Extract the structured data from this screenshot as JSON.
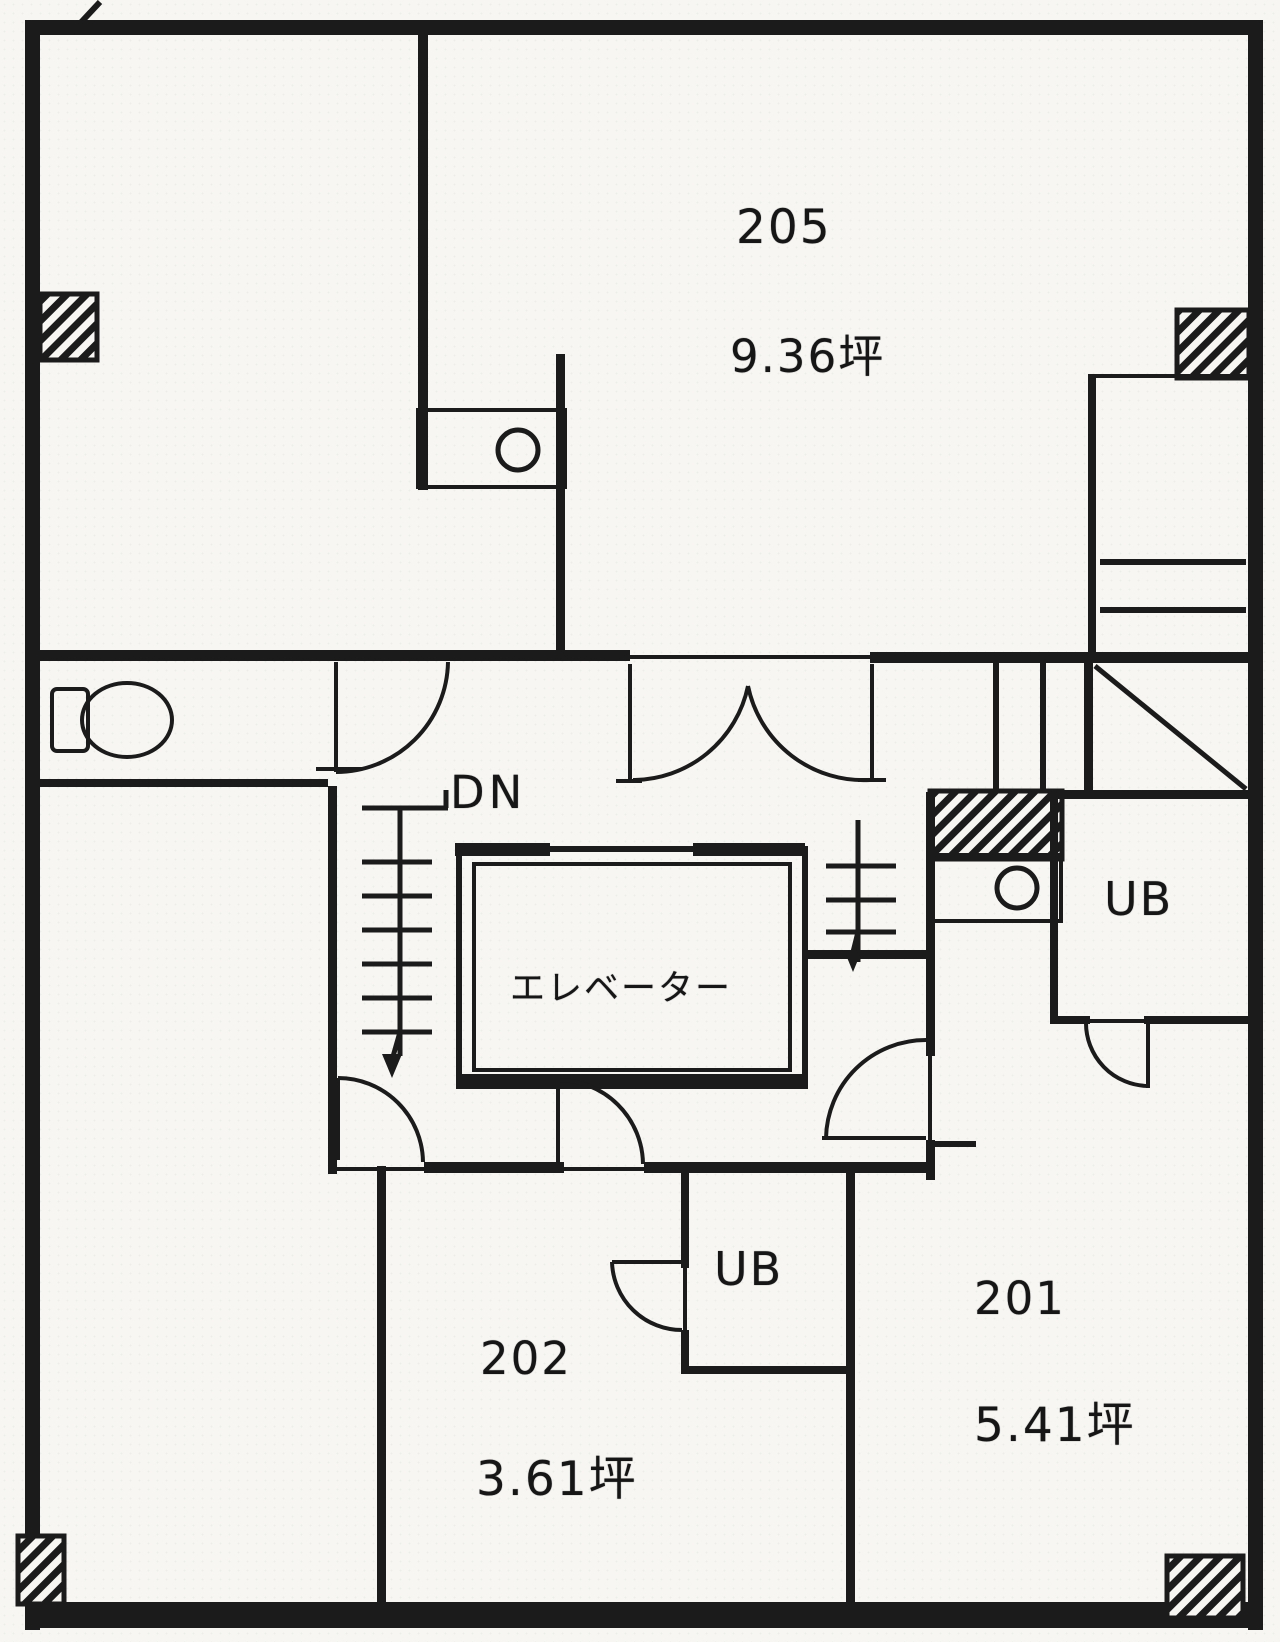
{
  "document": {
    "kind": "scanned architectural floor plan",
    "language": "Japanese"
  },
  "colors": {
    "ink": "#1b1b1b",
    "paper": "#f7f6f3"
  },
  "rooms": [
    {
      "number": "205",
      "area_label": "9.36坪",
      "area_tsubo": 9.36
    },
    {
      "number": "202",
      "area_label": "3.61坪",
      "area_tsubo": 3.61
    },
    {
      "number": "201",
      "area_label": "5.41坪",
      "area_tsubo": 5.41
    }
  ],
  "labels": {
    "elevator": "エレベーター",
    "stairs_down": "DN",
    "unit_bath": "UB"
  },
  "fixtures": [
    "elevator-shaft",
    "staircase-down",
    "toilet",
    "wash-basin",
    "unit-bath-upper",
    "unit-bath-lower",
    "closet-shelves",
    "structural-columns-hatched"
  ]
}
